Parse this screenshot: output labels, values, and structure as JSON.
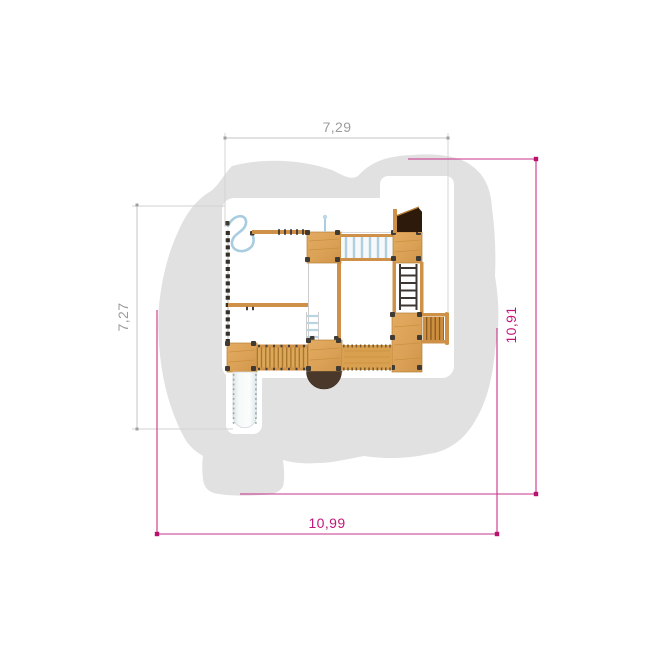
{
  "plan": {
    "type": "playground-top-view-dimension-plan",
    "dimensions": {
      "width_top": "7,29",
      "height_left": "7,27",
      "height_right": "10,91",
      "width_bottom": "10,99"
    },
    "colors": {
      "background": "#ffffff",
      "safety_zone": "#e1e1e1",
      "dimension_secondary": "#9c9c9c",
      "dimension_primary": "#c0187a",
      "wood": "#dfa55c",
      "wood_dark": "#b5803a",
      "roof_panel": "#2d1a0b",
      "posts": "#3f3b34",
      "rope_blue": "#aacde0",
      "slide": "#e9eef0",
      "tunnel": "#4a392b"
    }
  }
}
